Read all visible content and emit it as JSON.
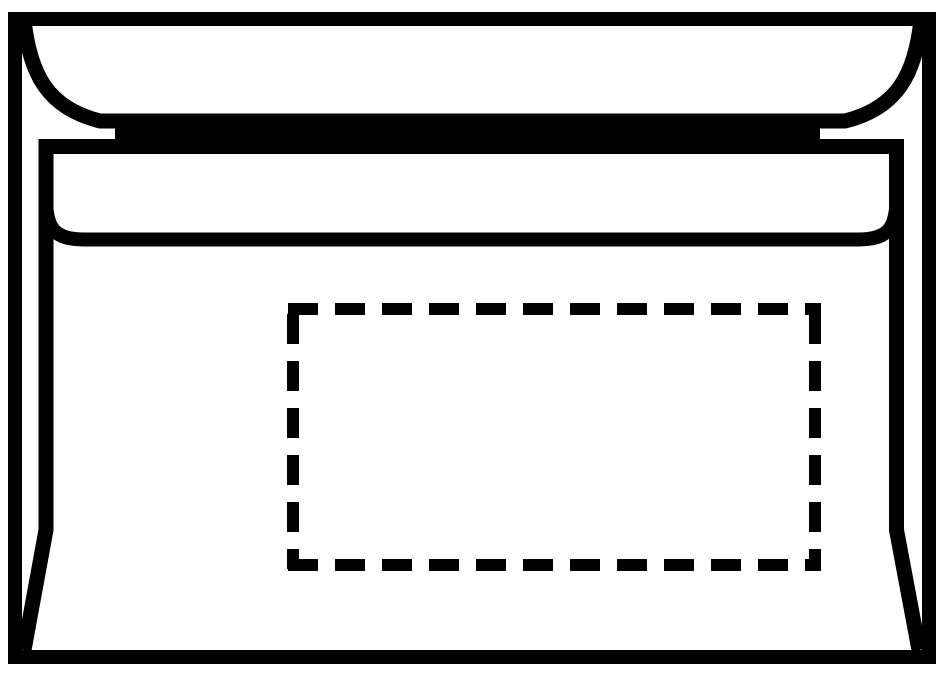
{
  "illustration": {
    "name": "window-envelope-back-line-drawing",
    "background_color": "#ffffff",
    "line_color": "#000000",
    "parts": {
      "outer_edge": "envelope outer edge",
      "flap_edge": "sealing flap curved edge",
      "seal_strip": "seal strip opening",
      "body_outline": "envelope back panel outline",
      "flap_seam": "flap seam line",
      "address_window": "address window position (dashed outline)"
    }
  }
}
